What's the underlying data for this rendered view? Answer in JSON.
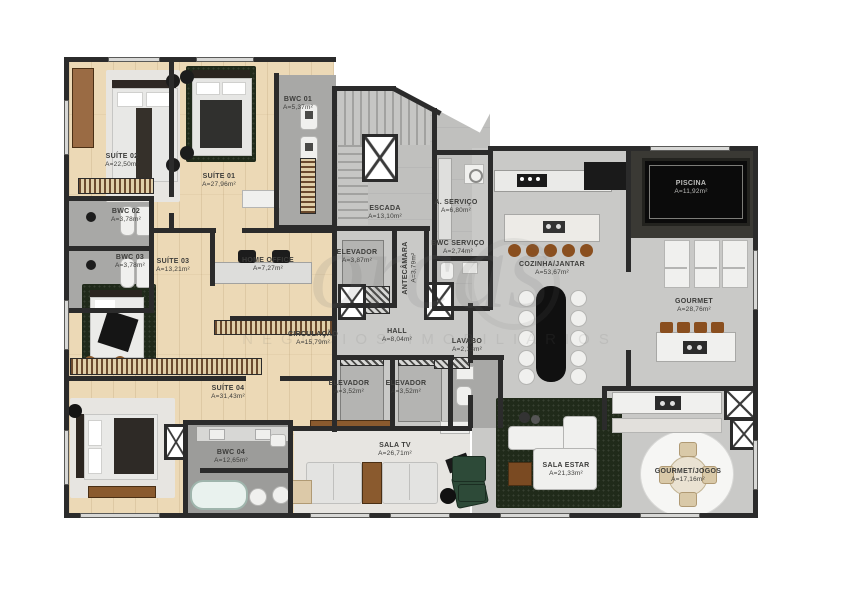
{
  "watermark": {
    "brand": "orcas",
    "subtitle": "NEGÓCIOS IMOBILIÁRIOS"
  },
  "colors": {
    "wall": "#2b2b2b",
    "wood_floor": "#ecd9b6",
    "social_floor": "#c9c9c7",
    "wet_floor": "#a8a8a6",
    "pool_water": "#0b0b0b",
    "accent_wood": "#8a5a2e",
    "rug_dark": "#202a1a"
  },
  "rooms": [
    {
      "id": "suite-02",
      "name": "SUÍTE 02",
      "area": "A=22,50m²"
    },
    {
      "id": "suite-01",
      "name": "SUÍTE 01",
      "area": "A=27,96m²"
    },
    {
      "id": "bwc-01",
      "name": "BWC 01",
      "area": "A=5,37m²"
    },
    {
      "id": "bwc-02",
      "name": "BWC 02",
      "area": "A=3,78m²"
    },
    {
      "id": "bwc-03",
      "name": "BWC 03",
      "area": "A=3,78m²"
    },
    {
      "id": "suite-03",
      "name": "SUÍTE 03",
      "area": "A=13,21m²"
    },
    {
      "id": "home-office",
      "name": "HOME OFFICE",
      "area": "A=7,27m²"
    },
    {
      "id": "circulacao",
      "name": "CIRCULAÇÃO",
      "area": "A=15,79m²"
    },
    {
      "id": "suite-04",
      "name": "SUÍTE 04",
      "area": "A=31,43m²"
    },
    {
      "id": "bwc-04",
      "name": "BWC 04",
      "area": "A=12,65m²"
    },
    {
      "id": "escada",
      "name": "ESCADA",
      "area": "A=13,10m²"
    },
    {
      "id": "elevador-1",
      "name": "ELEVADOR",
      "area": "A=3,87m²"
    },
    {
      "id": "antecamara",
      "name": "ANTECÂMARA",
      "area": "A=3,79m²"
    },
    {
      "id": "area-servico",
      "name": "A. SERVIÇO",
      "area": "A=6,80m²"
    },
    {
      "id": "bwc-servico",
      "name": "BWC SERVIÇO",
      "area": "A=2,74m²"
    },
    {
      "id": "hall",
      "name": "HALL",
      "area": "A=8,04m²"
    },
    {
      "id": "elevador-2",
      "name": "ELEVADOR",
      "area": "A=3,52m²"
    },
    {
      "id": "elevador-3",
      "name": "ELEVADOR",
      "area": "A=3,52m²"
    },
    {
      "id": "lavabo",
      "name": "LAVABO",
      "area": "A=2,13m²"
    },
    {
      "id": "cozinha-jantar",
      "name": "COZINHA/JANTAR",
      "area": "A=53,67m²"
    },
    {
      "id": "piscina",
      "name": "PISCINA",
      "area": "A=11,92m²"
    },
    {
      "id": "gourmet",
      "name": "GOURMET",
      "area": "A=28,76m²"
    },
    {
      "id": "sala-tv",
      "name": "SALA TV",
      "area": "A=26,71m²"
    },
    {
      "id": "sala-estar",
      "name": "SALA ESTAR",
      "area": "A=21,33m²"
    },
    {
      "id": "gourmet-jogos",
      "name": "GOURMET/JOGOS",
      "area": "A=17,16m²"
    }
  ]
}
